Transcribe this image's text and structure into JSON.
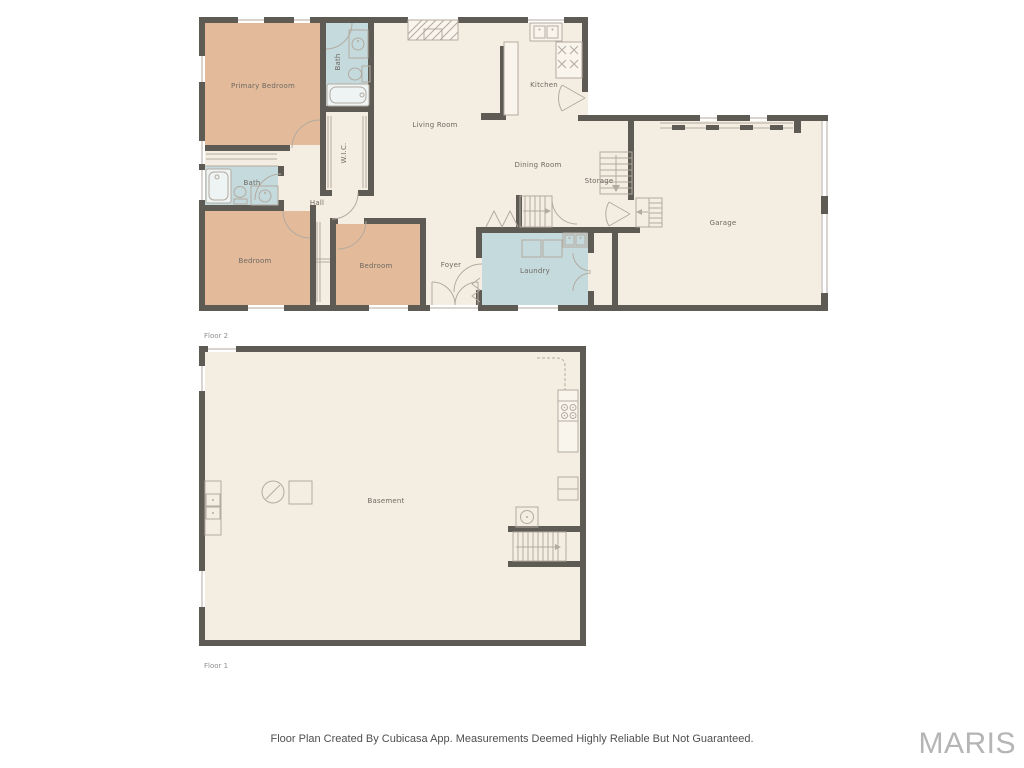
{
  "floor2": {
    "label": "Floor 2",
    "rooms": {
      "primary_bedroom": "Primary Bedroom",
      "bath_top": "Bath",
      "wic": "W.I.C.",
      "living_room": "Living Room",
      "kitchen": "Kitchen",
      "dining_room": "Dining Room",
      "storage": "Storage",
      "garage": "Garage",
      "bath_left": "Bath",
      "hall": "Hall",
      "bedroom_left": "Bedroom",
      "bedroom_mid": "Bedroom",
      "foyer": "Foyer",
      "laundry": "Laundry"
    }
  },
  "floor1": {
    "label": "Floor 1",
    "rooms": {
      "basement": "Basement"
    }
  },
  "footer": {
    "disclaimer": "Floor Plan Created By Cubicasa App. Measurements Deemed Highly Reliable But Not Guaranteed."
  },
  "watermark": {
    "text": "MARIS"
  },
  "colors": {
    "wall": "#5e5a54",
    "room_fill": "#f4eee2",
    "bedroom_fill": "#e3bb9a",
    "wet_fill": "#c5dadd",
    "counter_fill": "#f9f5ec",
    "line": "#b3aaa0",
    "label": "#6e6862",
    "floor_label": "#8e8e8e",
    "footer_text": "#4f4f4f",
    "watermark_text": "#b5b5b5"
  },
  "icons": {
    "bathtub": "rounded-rect-with-inner-outline",
    "toilet": "ellipse-with-tank",
    "sink": "circle-in-counter",
    "double-sink": "two-squares-with-dots",
    "stove-gas": "x-burner-marks",
    "stove-electric": "four-circles",
    "washer-dryer": "two-squares",
    "water-heater": "slashed-circle",
    "stairs": "parallel-treads-with-arrow",
    "door": "quarter-arc",
    "double-door": "fan-arc",
    "bifold-door": "zigzag",
    "window": "white-wall-gap-with-line",
    "garage-door": "dashed-line",
    "fireplace": "hatched-rect",
    "closet-rod": "double-line"
  }
}
